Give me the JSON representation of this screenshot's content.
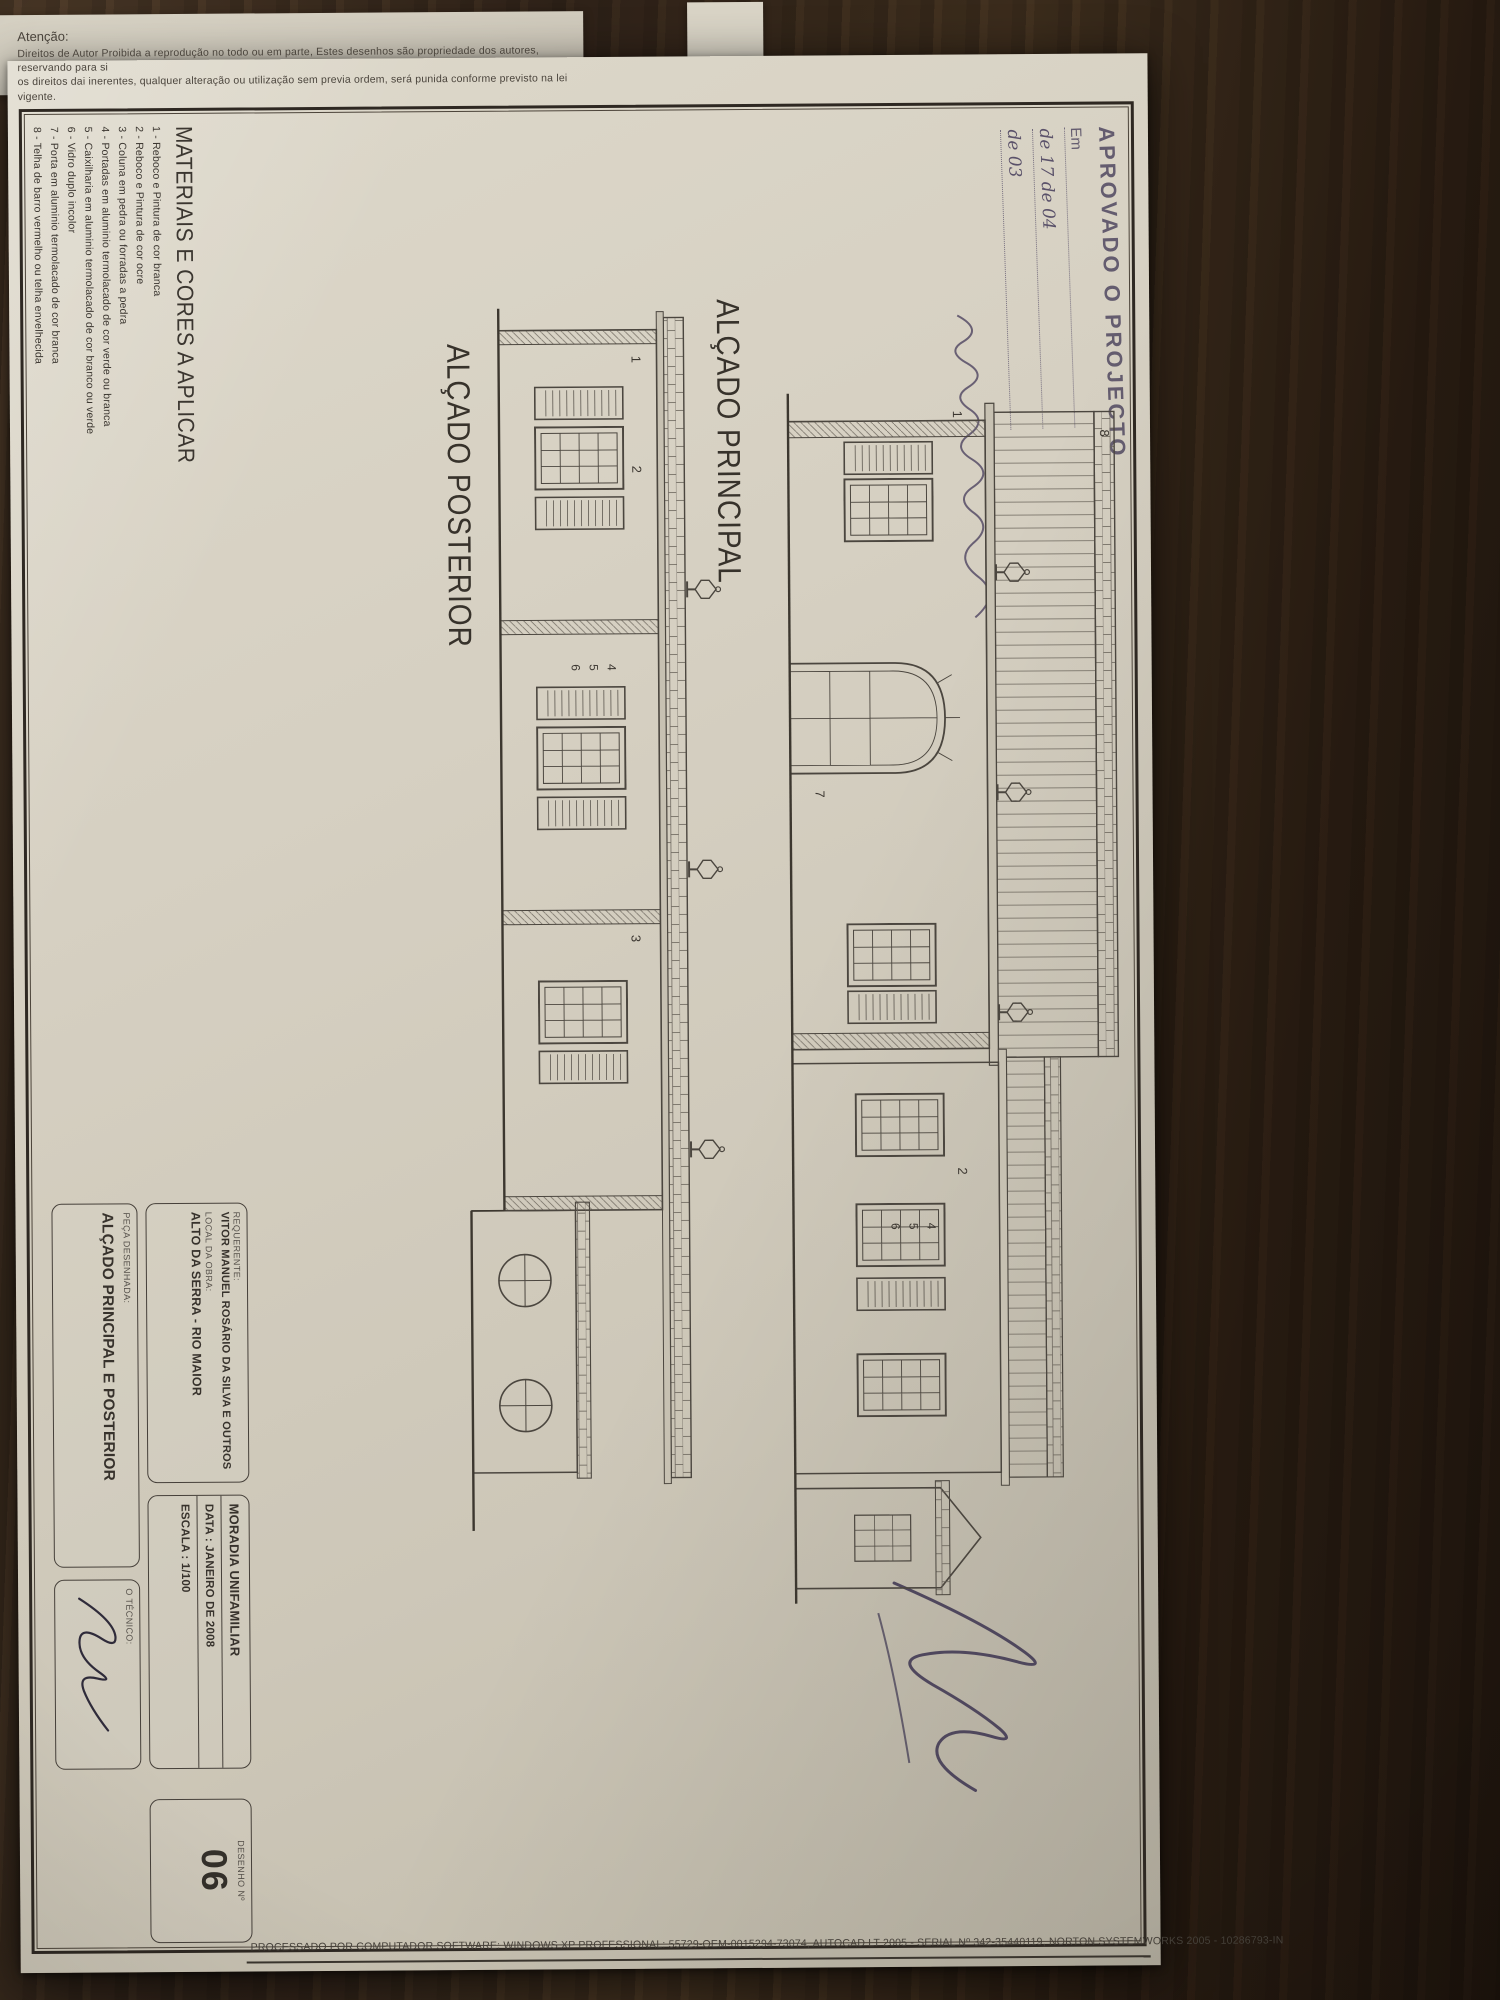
{
  "attention": {
    "title": "Atenção:",
    "line1": "Direitos de Autor Proibida a reprodução no todo ou em parte, Estes desenhos são propriedade dos autores, reservando para si",
    "line2": "os direitos dai inerentes, qualquer alteração ou utilização sem previa ordem, será punida conforme previsto na lei vigente."
  },
  "stamp": {
    "title": "APROVADO O PROJECTO",
    "em_label": "Em",
    "date_line_1": "de 17 de 04",
    "date_line_2": "de 03"
  },
  "drawings": {
    "principal": {
      "label": "ALÇADO PRINCIPAL",
      "numbers": [
        "8",
        "1",
        "7",
        "2",
        "4",
        "5",
        "6"
      ]
    },
    "posterior": {
      "label": "ALÇADO POSTERIOR",
      "numbers": [
        "1",
        "2",
        "4",
        "5",
        "6",
        "3"
      ]
    }
  },
  "materials": {
    "title": "MATERIAIS E CORES A APLICAR",
    "items": [
      "1 - Reboco e Pintura de cor branca",
      "2 - Reboco e Pintura de cor ocre",
      "3 - Coluna em pedra ou forradas a pedra",
      "4 - Portadas em aluminio termolacado de cor verde ou branca",
      "5 - Caixilharia em aluminio termolacado de cor branco ou verde",
      "6 - Vidro duplo incolor",
      "7 - Porta em aluminio termolacado de cor branca",
      "8 - Telha de barro vermelho ou telha envelhecida"
    ]
  },
  "titleblock": {
    "requerente_label": "REQUERENTE:",
    "requerente": "VITOR MANUEL ROSÁRIO DA SILVA E OUTROS",
    "local_label": "LOCAL DA OBRA:",
    "local": "ALTO DA SERRA - RIO MAIOR",
    "peca_label": "PEÇA DESENHADA:",
    "peca": "ALÇADO PRINCIPAL E POSTERIOR",
    "moradia": "MORADIA UNIFAMILIAR",
    "data": "DATA : JANEIRO DE 2008",
    "escala": "ESCALA : 1/100",
    "tecnico_label": "O TÉCNICO:",
    "desenho_label": "DESENHO  Nº",
    "desenho_num": "06"
  },
  "footer": {
    "processed": "PROCESSADO POR COMPUTADOR SOFTWARE: WINDOWS XP PROFESSIONAL:  55729-OEM-0015294-73074,  AUTOCAD LT 2005 - SERIAL Nº  342-35440119, NORTON SYSTEMWORKS 2005 - 10286793-IN"
  },
  "colors": {
    "paper": "#d6d0c2",
    "ink": "#37322b",
    "stamp_ink": "#585066",
    "wood": "#33251a"
  }
}
